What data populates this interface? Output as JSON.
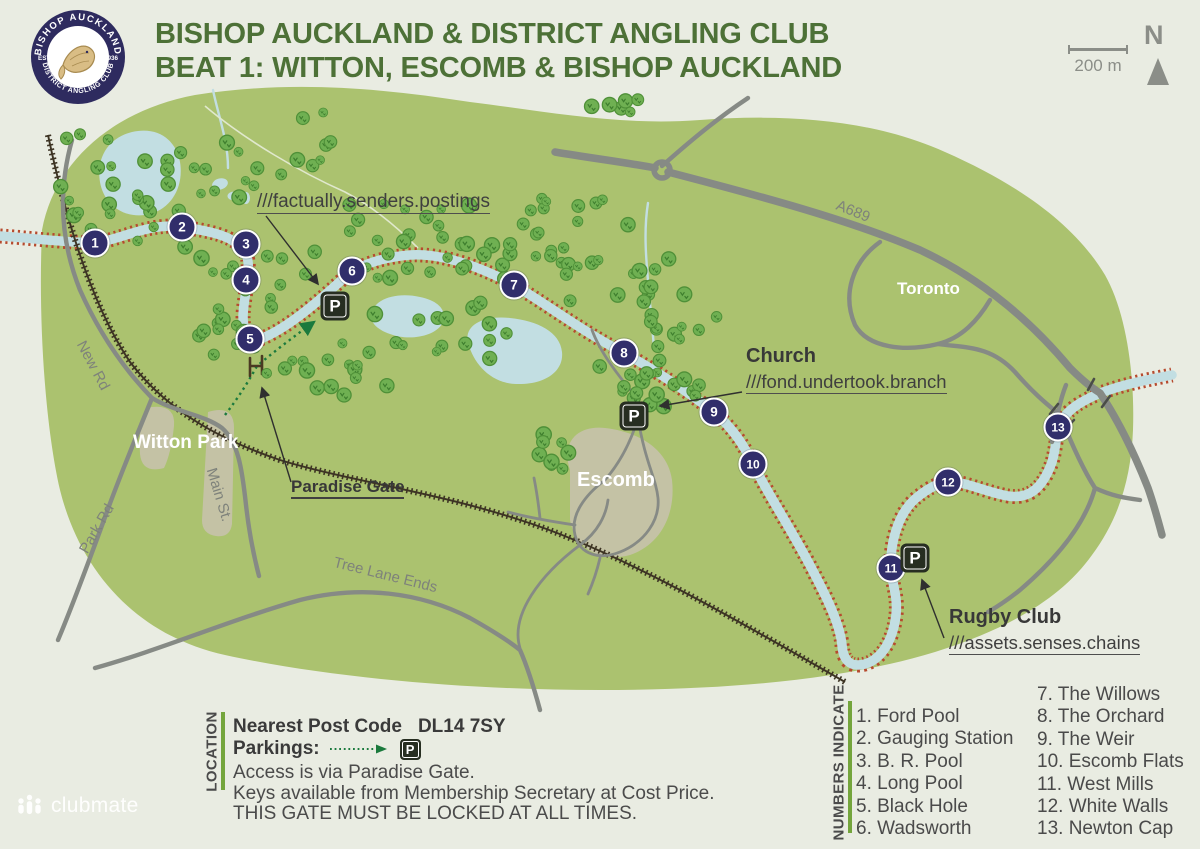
{
  "colors": {
    "bg": "#e9ece2",
    "map_green": "#abc26f",
    "river": "#c2dee2",
    "bank_red": "#b64a2e",
    "road": "#868a85",
    "navy": "#312e6b",
    "title_green": "#4d7137",
    "legend_bar": "#74a53c",
    "railway": "#3d3424",
    "tree_green": "#6fb052",
    "annotation_ink": "#3f3f3f",
    "badge_navy": "#2e2b5f",
    "fish_gold": "#c9a86a"
  },
  "header": {
    "logo": {
      "arc_top": "BISHOP AUCKLAND",
      "arc_bottom": "DISTRICT ANGLING CLUB",
      "est": "EST",
      "year": "1936"
    },
    "title_line1": "BISHOP AUCKLAND & DISTRICT ANGLING CLUB",
    "title_line2": "BEAT 1: WITTON, ESCOMB & BISHOP AUCKLAND"
  },
  "controls": {
    "scale_label": "200 m",
    "north_label": "N"
  },
  "map": {
    "parking_letter": "P",
    "markers": [
      {
        "n": "1",
        "x": 95,
        "y": 243
      },
      {
        "n": "2",
        "x": 182,
        "y": 227
      },
      {
        "n": "3",
        "x": 246,
        "y": 244
      },
      {
        "n": "4",
        "x": 246,
        "y": 280
      },
      {
        "n": "5",
        "x": 250,
        "y": 339
      },
      {
        "n": "6",
        "x": 352,
        "y": 271
      },
      {
        "n": "7",
        "x": 514,
        "y": 285
      },
      {
        "n": "8",
        "x": 624,
        "y": 353
      },
      {
        "n": "9",
        "x": 714,
        "y": 412
      },
      {
        "n": "10",
        "x": 753,
        "y": 464
      },
      {
        "n": "11",
        "x": 891,
        "y": 568
      },
      {
        "n": "12",
        "x": 948,
        "y": 482
      },
      {
        "n": "13",
        "x": 1058,
        "y": 427
      }
    ],
    "parkings": [
      {
        "x": 335,
        "y": 306
      },
      {
        "x": 634,
        "y": 416
      },
      {
        "x": 915,
        "y": 558
      }
    ],
    "place_labels": [
      {
        "text": "Witton Park",
        "x": 133,
        "y": 432,
        "size": 19
      },
      {
        "text": "Escomb",
        "x": 577,
        "y": 469,
        "size": 20
      },
      {
        "text": "Toronto",
        "x": 897,
        "y": 279,
        "size": 17
      }
    ],
    "road_labels": [
      {
        "text": "New Rd",
        "x": 88,
        "y": 338,
        "rotate": 62
      },
      {
        "text": "Park Rd",
        "x": 76,
        "y": 548,
        "rotate": -60
      },
      {
        "text": "Main St.",
        "x": 219,
        "y": 466,
        "rotate": 73
      },
      {
        "text": "Tree Lane Ends",
        "x": 336,
        "y": 554,
        "rotate": 14
      },
      {
        "text": "A689",
        "x": 840,
        "y": 197,
        "rotate": 22
      }
    ],
    "annotations": [
      {
        "id": "w3w-postings",
        "title": "",
        "w3w": "///factually.senders.postings",
        "x": 257,
        "y": 188,
        "w3w_size": 19
      },
      {
        "id": "church",
        "title": "Church",
        "w3w": "///fond.undertook.branch",
        "x": 746,
        "y": 345
      },
      {
        "id": "rugby-club",
        "title": "Rugby Club",
        "w3w": "///assets.senses.chains",
        "x": 949,
        "y": 606
      },
      {
        "id": "paradise-gate",
        "title": "Paradise Gate",
        "w3w": "",
        "underline_title": true,
        "title_size": 17,
        "x": 291,
        "y": 477
      }
    ],
    "tree_clusters": [
      [
        150,
        190,
        180,
        115,
        32
      ],
      [
        258,
        300,
        120,
        150,
        26
      ],
      [
        318,
        368,
        100,
        55,
        12
      ],
      [
        455,
        240,
        220,
        85,
        38
      ],
      [
        600,
        250,
        140,
        110,
        22
      ],
      [
        680,
        312,
        80,
        60,
        12
      ],
      [
        445,
        345,
        170,
        85,
        18
      ],
      [
        625,
        375,
        80,
        65,
        12
      ],
      [
        556,
        455,
        36,
        50,
        8
      ],
      [
        628,
        103,
        75,
        18,
        6
      ],
      [
        292,
        150,
        115,
        75,
        12
      ],
      [
        668,
        388,
        70,
        40,
        8
      ]
    ]
  },
  "legend_location": {
    "title": "LOCATION",
    "postcode_label": "Nearest Post Code",
    "postcode": "DL14 7SY",
    "parkings_label": "Parkings:",
    "lines": [
      "Access is via Paradise Gate.",
      "Keys available from Membership Secretary at Cost Price.",
      "THIS GATE MUST BE LOCKED AT ALL TIMES."
    ]
  },
  "legend_numbers": {
    "title": "NUMBERS INDICATE",
    "col1": [
      "1. Ford Pool",
      "2. Gauging Station",
      "3. B. R. Pool",
      "4. Long Pool",
      "5. Black Hole",
      "6. Wadsworth"
    ],
    "col2": [
      "7. The Willows",
      "8. The Orchard",
      "9. The Weir",
      "10. Escomb Flats",
      "11. West Mills",
      "12. White Walls",
      "13. Newton Cap"
    ]
  },
  "footer": {
    "brand": "clubmate"
  }
}
